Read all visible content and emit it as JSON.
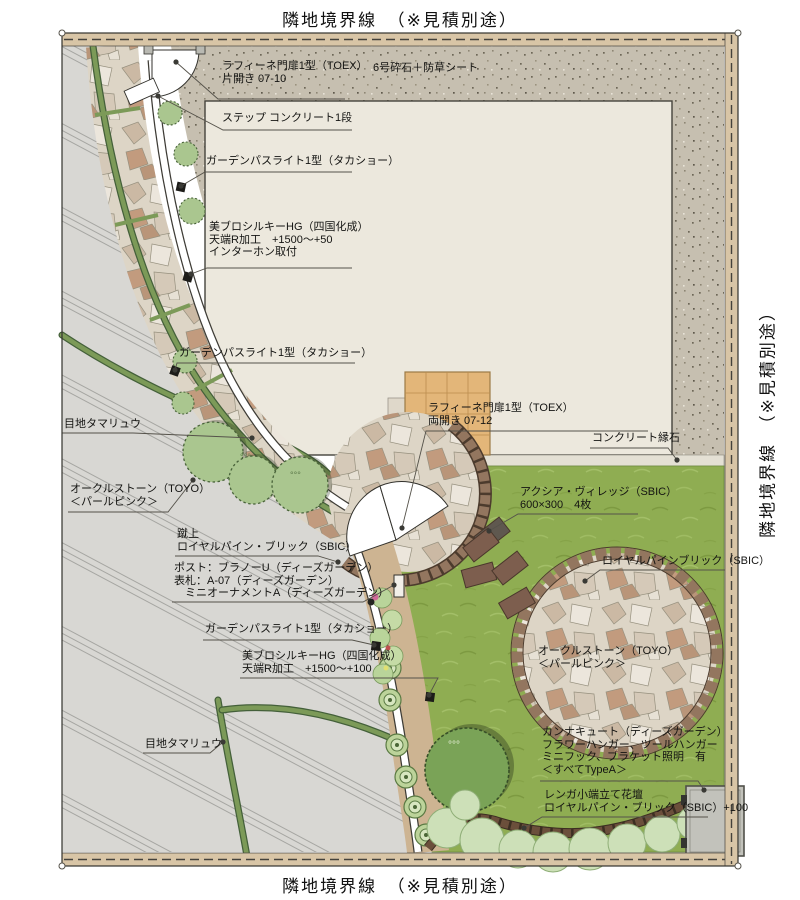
{
  "plan": {
    "boundary_label_top": "隣地境界線　（※見積別途）",
    "boundary_label_right": "隣地境界線　（※見積別途）",
    "boundary_label_bottom": "隣地境界線　（※見積別途）"
  },
  "annotations": [
    {
      "id": "gate-single",
      "lines": [
        "ラフィーネ門扉1型（TOEX）",
        "片開き 07-10"
      ]
    },
    {
      "id": "gravel-sheet",
      "lines": [
        "6号砕石＋防草シート"
      ]
    },
    {
      "id": "step-concrete",
      "lines": [
        "ステップ コンクリート1段"
      ]
    },
    {
      "id": "pathlight-1",
      "lines": [
        "ガーデンパスライト1型（タカショー）"
      ]
    },
    {
      "id": "wall-upper",
      "lines": [
        "美ブロシルキーHG（四国化成）",
        "天端R加工　+1500～+50",
        "インターホン取付"
      ]
    },
    {
      "id": "pathlight-2",
      "lines": [
        "ガーデンパスライト1型（タカショー）"
      ]
    },
    {
      "id": "joint-tamaryu-upper",
      "lines": [
        "目地タマリュウ"
      ]
    },
    {
      "id": "ocru-stone-left",
      "lines": [
        "オークルストーン（TOYO）",
        "＜パールピンク＞"
      ]
    },
    {
      "id": "riser-brick",
      "lines": [
        "蹴上",
        "ロイヤルパイン・ブリック（SBIC）"
      ]
    },
    {
      "id": "post-nameplate",
      "lines": [
        "ポスト：ブラノーU（ディーズガーデン）",
        "表札：A-07（ディーズガーデン）",
        "　ミニオーナメントA（ディーズガーデン）"
      ]
    },
    {
      "id": "pathlight-3",
      "lines": [
        "ガーデンパスライト1型（タカショー）"
      ]
    },
    {
      "id": "wall-lower",
      "lines": [
        "美ブロシルキーHG（四国化成）",
        "天端R加工　+1500～+100"
      ]
    },
    {
      "id": "joint-tamaryu-lower",
      "lines": [
        "目地タマリュウ"
      ]
    },
    {
      "id": "gate-double",
      "lines": [
        "ラフィーネ門扉1型（TOEX）",
        "両開き 07-12"
      ]
    },
    {
      "id": "concrete-curb",
      "lines": [
        "コンクリート縁石"
      ]
    },
    {
      "id": "axia-village",
      "lines": [
        "アクシア・ヴィレッジ（SBIC）",
        "600×300　4枚"
      ]
    },
    {
      "id": "royal-pine-brick",
      "lines": [
        "ロイヤルパインブリック（SBIC）"
      ]
    },
    {
      "id": "ocru-stone-circle",
      "lines": [
        "オークルストーン（TOYO）",
        "＜パールピンク＞"
      ]
    },
    {
      "id": "canna-cute",
      "lines": [
        "カンナキュート（ディーズガーデン）",
        "フラワーハンガー、ツールハンガー",
        "ミニフック、ブラケット照明　有",
        "＜すべてTypeA＞"
      ]
    },
    {
      "id": "brick-flowerbed",
      "lines": [
        "レンガ小端立て花壇",
        "ロイヤルパイン・ブリック（SBIC）+100"
      ]
    }
  ],
  "colors": {
    "lawn_green": "#8fad52",
    "gravel": "#c6bfb0",
    "concrete": "#d8d7d3",
    "house": "#ece8dd",
    "flagstone": "#ddd5c6",
    "brick_edge": "#8a6a55",
    "tile_terrace": "#e3b679",
    "boundary_strip": "#d8c5a6",
    "tamaryu_green": "#7c9a58"
  }
}
